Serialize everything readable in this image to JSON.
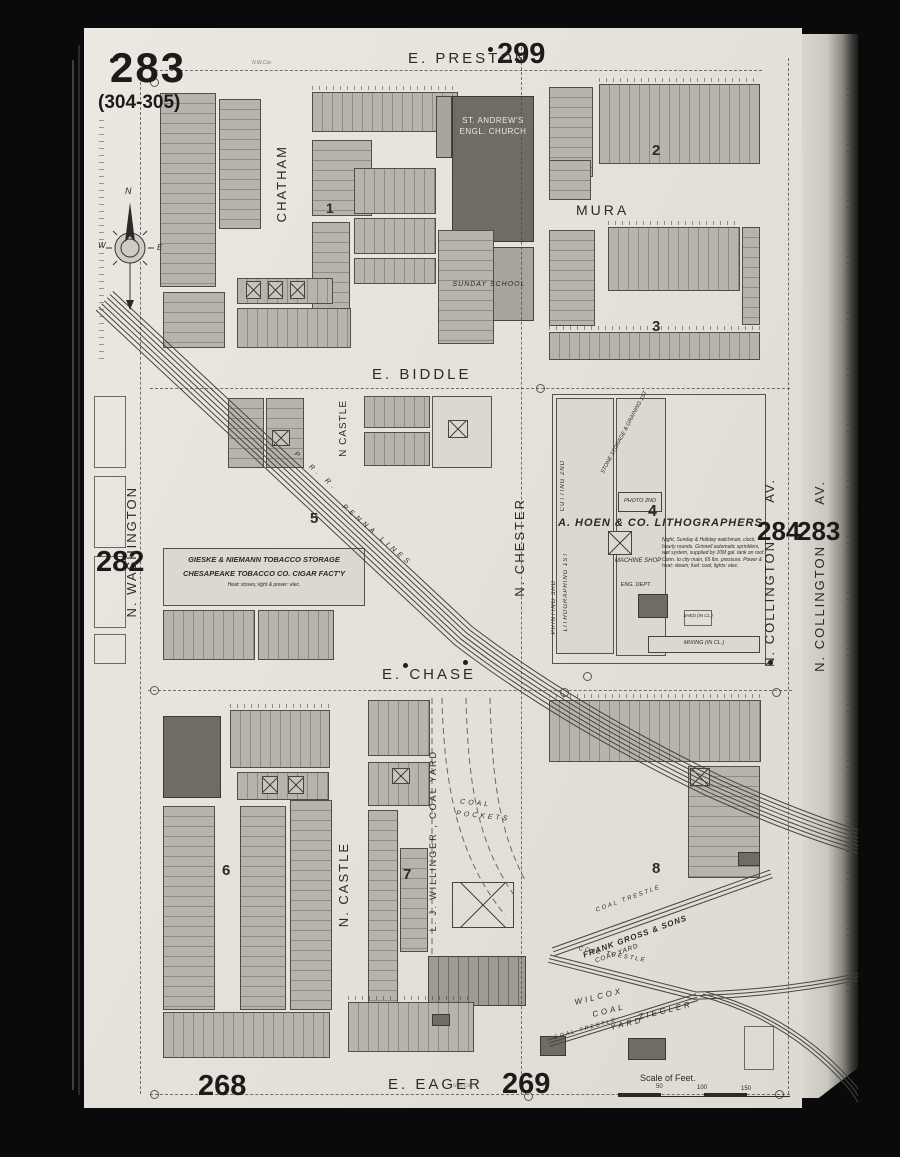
{
  "page_numbers": {
    "main": "283",
    "alt": "(304-305)",
    "top_right": "299",
    "left": "282",
    "right_a": "284",
    "right_b": "283",
    "bottom_left": "268",
    "bottom_right": "269"
  },
  "streets": {
    "preston": "E. PRESTON",
    "biddle": "E. BIDDLE",
    "chase": "E. CHASE",
    "eager": "E. EAGER",
    "mura": "MURA",
    "chatham": "CHATHAM",
    "washington": "N. WASHINGTON",
    "castle_upper": "N CASTLE",
    "castle_lower": "N. CASTLE",
    "chester": "N. CHESTER",
    "collington_name": "N. COLLINGTON",
    "collington_suffix": "AV.",
    "collington2_name": "N. COLLINGTON",
    "collington2_suffix": "AV."
  },
  "block_numbers": {
    "b1": "1",
    "b2": "2",
    "b3": "3",
    "b4": "4",
    "b5": "5",
    "b6": "6",
    "b7": "7",
    "b8": "8"
  },
  "buildings": {
    "church_line1": "ST. ANDREW'S",
    "church_line2": "ENGL. CHURCH",
    "sunday_school": "SUNDAY SCHOOL",
    "hoen_title": "A. HOEN & CO. LITHOGRAPHERS",
    "hoen_note": "Night, Sunday & Holiday watchman, clock, hourly rounds. Grinnell automatic sprinklers, wet system, supplied by 10M gal. tank on roof. Conn. to city main, 65 lbs. pressure. Power & heat: steam; fuel: coal; lights: elec.",
    "hoen_cutting": "CUTTING 2ND",
    "hoen_printing": "PRINTING 3RD",
    "hoen_litho": "LITHOGRAPHING 1ST",
    "hoen_stone": "STONE STORAGE & GRAINING 1ST",
    "hoen_photo": "PHOTO 2ND",
    "hoen_machine": "MACHINE SHOP",
    "hoen_eng": "ENG. DEPT.",
    "hoen_shed": "SHED (IN CL.)",
    "hoen_mixing": "MIXING (IN CL.)",
    "gieske_line1": "GIESKE & NIEMANN TOBACCO STORAGE",
    "gieske_line2": "CHESAPEAKE TOBACCO CO. CIGAR FACT'Y",
    "gieske_line3": "Heat: stoves; light & power: elec."
  },
  "coal": {
    "pockets_line1": "COAL",
    "pockets_line2": "POCKETS",
    "willinger": "L. J. WILLINGER , COAL YARD",
    "gross_line1": "FRANK GROSS & SONS",
    "gross_line2": "COAL YARD",
    "wilcox_line1": "WILCOX",
    "wilcox_line2": "COAL",
    "wilcox_line3": "YARD",
    "ziegler": "ZIEGLER",
    "trestle1": "COAL TRESTLE",
    "trestle2": "COAL TRESTLE",
    "trestle3": "COAL TRESTLE"
  },
  "railroad": {
    "label1": "P. R. R.",
    "label2": "PENNA LINES"
  },
  "compass": {
    "n": "N",
    "e": "E",
    "w": "W"
  },
  "scale": {
    "label": "Scale of Feet.",
    "t50": "50",
    "t100": "100",
    "t150": "150"
  },
  "annotations": {
    "corner_note": "N.W.Cor."
  },
  "colors": {
    "paper": "#e4e2da",
    "block_gray": "#b6b4ac",
    "dark_building": "#6e6c64",
    "ink": "#2b2a25"
  }
}
